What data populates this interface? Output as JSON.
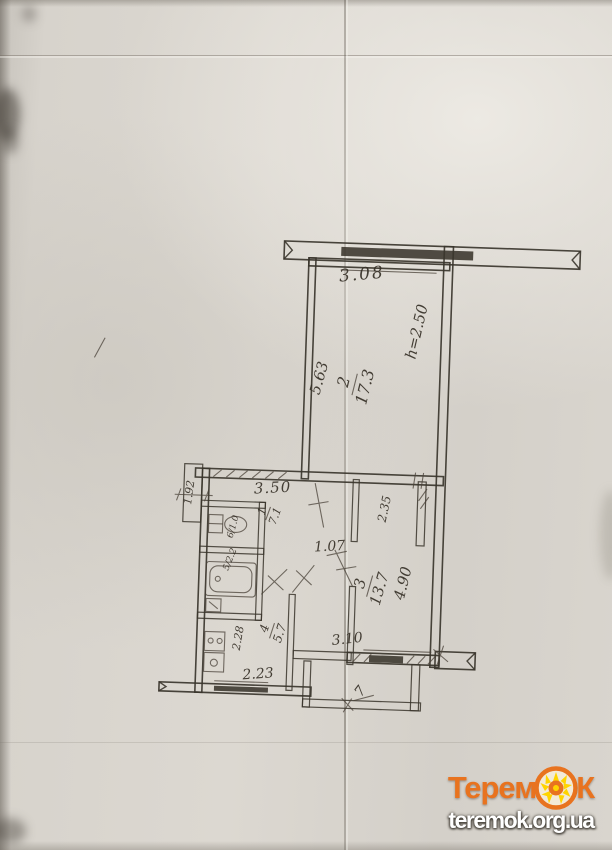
{
  "page": {
    "background_hex": "#d7d3cc",
    "line_hex": "#3a352c",
    "ink_hex": "#332d24",
    "description": "Scanned hand-drawn apartment floor plan"
  },
  "floor_plan": {
    "rooms": {
      "living": {
        "number": "2",
        "area": "17.3"
      },
      "bedroom": {
        "number": "3",
        "area": "13.7"
      },
      "kitchen": {
        "number": "4",
        "area": "5.7"
      },
      "hall": {
        "number": "1",
        "area": "7.1"
      },
      "bathroom": {
        "label": "5/2.2"
      },
      "toilet": {
        "label": "6/1.0"
      },
      "balcony": {
        "number": "7"
      }
    },
    "dimensions": {
      "balcony_top_width": "3.08",
      "living_height": "5.63",
      "ceiling_height": "h=2.50",
      "hall_width": "3.50",
      "duct_width": "1.92",
      "closet_depth": "2.35",
      "bedroom_door": "1.07",
      "bedroom_height": "4.90",
      "bedroom_width": "3.10",
      "kitchen_depth": "2.28",
      "kitchen_width": "2.23"
    }
  },
  "watermark": {
    "brand_prefix": "Терем",
    "brand_suffix": "К",
    "url": "teremok.org.ua",
    "orange_hex": "#e8731f",
    "yellow_hex": "#ffd400"
  }
}
